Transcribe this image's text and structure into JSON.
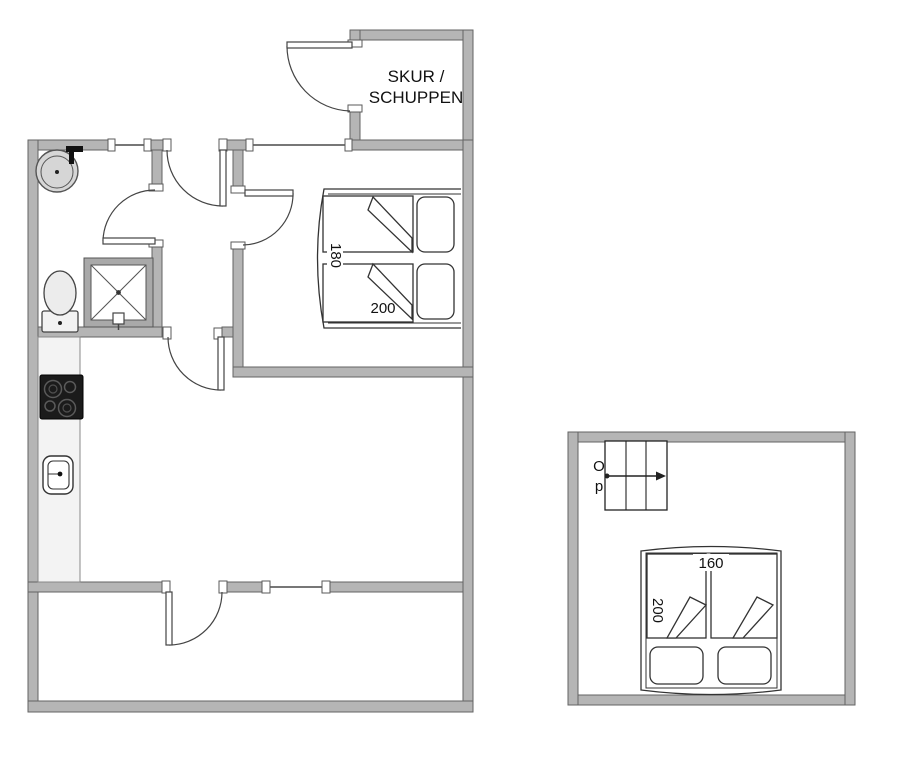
{
  "floorplan": {
    "ground_floor": {
      "shed": {
        "label_line1": "SKUR /",
        "label_line2": "SCHUPPEN"
      },
      "bedroom": {
        "bed_width_cm": "180",
        "bed_length_cm": "200"
      },
      "fixture_icons": [
        "washbasin-icon",
        "toilet-icon",
        "shower-icon",
        "cooktop-icon",
        "kitchen-sink-icon",
        "kitchen-counter",
        "double-bed",
        "entry-door",
        "bathroom-door",
        "bedroom-door",
        "hall-door",
        "terrace-door",
        "shed-door",
        "window"
      ]
    },
    "upper_floor": {
      "stairs": {
        "label_top": "O",
        "label_bottom": "p",
        "direction": "arrow-right"
      },
      "bed": {
        "bed_width_cm": "160",
        "bed_length_cm": "200"
      }
    },
    "colors": {
      "background": "#ffffff",
      "wall_fill": "#b5b5b5",
      "wall_outline": "#636363",
      "line": "#333333",
      "counter_fill": "#f3f3f3",
      "cooktop_fill": "#1b1b1b",
      "sink_fill": "#d6d6d6",
      "shower_frame": "#a9a9a9"
    }
  }
}
